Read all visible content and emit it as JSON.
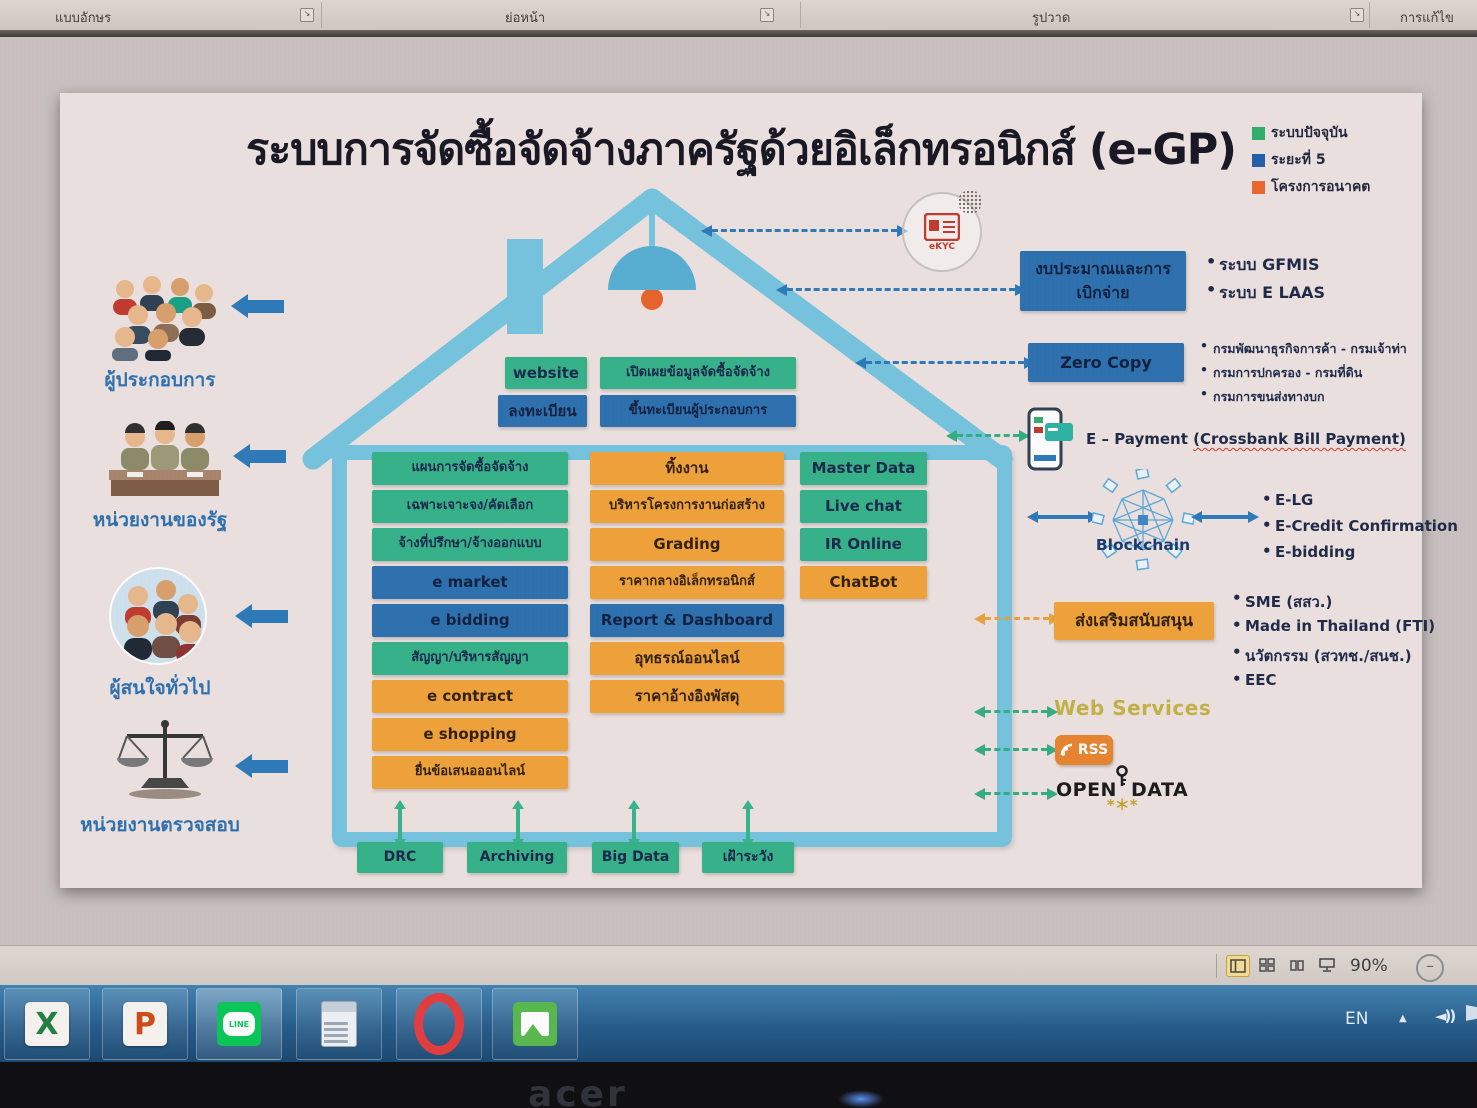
{
  "ribbon": {
    "groups": [
      {
        "label": "แบบอักษร"
      },
      {
        "label": "ย่อหน้า"
      },
      {
        "label": "รูปวาด"
      },
      {
        "label": "การแก้ไข"
      }
    ]
  },
  "slide": {
    "title": "ระบบการจัดซื้อจัดจ้างภาครัฐด้วยอิเล็กทรอนิกส์ (e-GP)",
    "legend": {
      "items": [
        {
          "label": "ระบบปัจจุบัน",
          "color": "#2eae67",
          "phase": "current"
        },
        {
          "label": "ระยะที่ 5",
          "color": "#1f5fa8",
          "phase": "phase5"
        },
        {
          "label": "โครงการอนาคต",
          "color": "#e8682a",
          "phase": "future"
        }
      ]
    },
    "palette": {
      "current": "#33b287",
      "phase5": "#2a6fae",
      "future": "#f0a236"
    },
    "stakeholders": {
      "items": [
        {
          "label": "ผู้ประกอบการ",
          "icon": "crowd-icon"
        },
        {
          "label": "หน่วยงานของรัฐ",
          "icon": "government-officials-icon"
        },
        {
          "label": "ผู้สนใจทั่วไป",
          "icon": "general-public-icon"
        },
        {
          "label": "หน่วยงานตรวจสอบ",
          "icon": "scales-icon"
        }
      ]
    },
    "roof": {
      "row1": [
        {
          "label": "website",
          "phase": "current"
        },
        {
          "label": "เปิดเผยข้อมูลจัดซื้อจัดจ้าง",
          "phase": "current"
        }
      ],
      "row2": [
        {
          "label": "ลงทะเบียน",
          "phase": "phase5"
        },
        {
          "label": "ขึ้นทะเบียนผู้ประกอบการ",
          "phase": "phase5"
        }
      ]
    },
    "columns": {
      "left": [
        {
          "label": "แผนการจัดซื้อจัดจ้าง",
          "phase": "current"
        },
        {
          "label": "เฉพาะเจาะจง/คัดเลือก",
          "phase": "current"
        },
        {
          "label": "จ้างที่ปรึกษา/จ้างออกแบบ",
          "phase": "current"
        },
        {
          "label": "e market",
          "phase": "phase5"
        },
        {
          "label": "e bidding",
          "phase": "phase5"
        },
        {
          "label": "สัญญา/บริหารสัญญา",
          "phase": "current"
        },
        {
          "label": "e contract",
          "phase": "future"
        },
        {
          "label": "e shopping",
          "phase": "future"
        },
        {
          "label": "ยื่นข้อเสนอออนไลน์",
          "phase": "future"
        }
      ],
      "middle": [
        {
          "label": "ทิ้งงาน",
          "phase": "future"
        },
        {
          "label": "บริหารโครงการงานก่อสร้าง",
          "phase": "future"
        },
        {
          "label": "Grading",
          "phase": "future"
        },
        {
          "label": "ราคากลางอิเล็กทรอนิกส์",
          "phase": "future"
        },
        {
          "label": "Report & Dashboard",
          "phase": "phase5"
        },
        {
          "label": "อุทธรณ์ออนไลน์",
          "phase": "future"
        },
        {
          "label": "ราคาอ้างอิงพัสดุ",
          "phase": "future"
        }
      ],
      "right": [
        {
          "label": "Master Data",
          "phase": "current"
        },
        {
          "label": "Live chat",
          "phase": "current"
        },
        {
          "label": "IR Online",
          "phase": "current"
        },
        {
          "label": "ChatBot",
          "phase": "future"
        }
      ]
    },
    "right_panel": {
      "ekyc": {
        "label": "eKYC"
      },
      "budget": {
        "line1": "งบประมาณและการ",
        "line2": "เบิกจ่าย",
        "bullets": [
          "ระบบ GFMIS",
          "ระบบ E LAAS"
        ]
      },
      "zero_copy": {
        "label": "Zero Copy",
        "bullets": [
          "กรมพัฒนาธุรกิจการค้า - กรมเจ้าท่า",
          "กรมการปกครอง - กรมที่ดิน",
          "กรมการขนส่งทางบก"
        ]
      },
      "epayment": {
        "label": "E – Payment",
        "paren": "(Crossbank Bill Payment)"
      },
      "blockchain": {
        "label": "Blockchain",
        "bullets": [
          "E-LG",
          "E-Credit Confirmation",
          "E-bidding"
        ]
      },
      "support": {
        "label": "ส่งเสริมสนับสนุน",
        "bullets": [
          "SME (สสว.)",
          "Made in Thailand (FTI)",
          "นวัตกรรม (สวทช./สนช.)",
          "EEC"
        ]
      },
      "web_services": {
        "label": "Web Services"
      },
      "rss": {
        "label": "RSS"
      },
      "open_data": {
        "word1": "OPEN",
        "word2": "DATA"
      }
    },
    "bottom_boxes": [
      {
        "label": "DRC"
      },
      {
        "label": "Archiving"
      },
      {
        "label": "Big Data"
      },
      {
        "label": "เฝ้าระวัง"
      }
    ]
  },
  "status_bar": {
    "zoom_level": "90%"
  },
  "taskbar": {
    "icons": [
      {
        "name": "excel"
      },
      {
        "name": "powerpoint"
      },
      {
        "name": "line",
        "label": "LINE"
      },
      {
        "name": "calculator"
      },
      {
        "name": "opera"
      },
      {
        "name": "photo-viewer"
      }
    ],
    "tray": {
      "language": "EN"
    }
  },
  "device": {
    "brand": "acer"
  }
}
